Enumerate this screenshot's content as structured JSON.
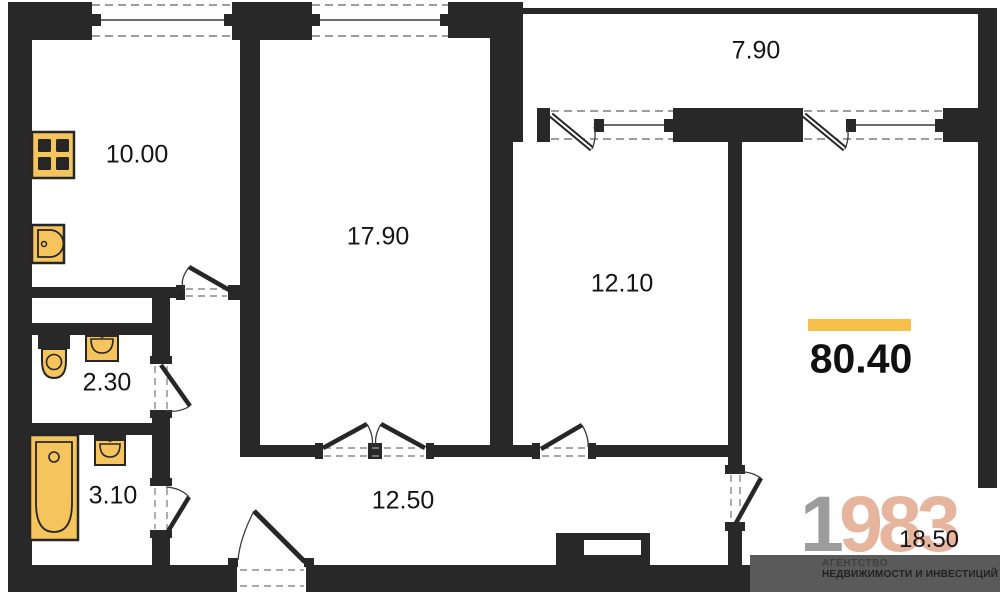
{
  "plan": {
    "total_area": "80.40",
    "rooms": {
      "kitchen": {
        "area": "10.00"
      },
      "living": {
        "area": "17.90"
      },
      "bedroom1": {
        "area": "12.10"
      },
      "bedroom2": {
        "area": "18.50"
      },
      "balcony": {
        "area": "7.90"
      },
      "wc": {
        "area": "2.30"
      },
      "bathroom": {
        "area": "3.10"
      },
      "hallway": {
        "area": "12.50"
      }
    },
    "fixtures": [
      "stove-icon",
      "kitchen-sink-icon",
      "toilet-icon",
      "wc-sink-icon",
      "bathtub-icon",
      "bath-sink-icon"
    ],
    "colors": {
      "wall": "#282828",
      "fixture_fill": "#f5c45c",
      "accent_bar": "#f6c04a",
      "footer_band": "#5a5a5a",
      "logo_gray": "#9c9c9c",
      "logo_accent": "#e7b59e"
    }
  },
  "logo": {
    "year_gray": "1",
    "year_accent": "983",
    "tagline_line1": "АГЕНТСТВО",
    "tagline_line2": "НЕДВИЖИМОСТИ И ИНВЕСТИЦИЙ"
  }
}
